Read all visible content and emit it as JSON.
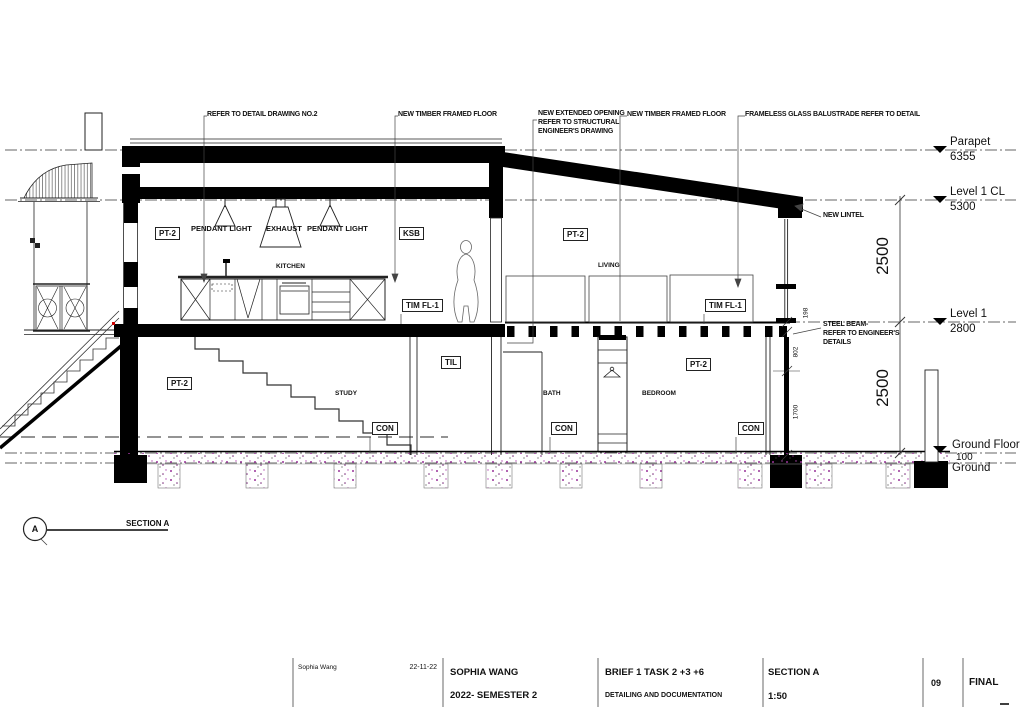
{
  "drawing": {
    "callouts": {
      "c1": "REFER TO DETAIL DRAWING NO.2",
      "c2": "NEW TIMBER FRAMED FLOOR",
      "c3": "NEW EXTENDED OPENING\nREFER TO STRUCTURAL\nENGINEER'S DRAWING",
      "c4": "NEW TIMBER FRAMED FLOOR",
      "c5": "FRAMELESS GLASS BALUSTRADE REFER TO DETAIL",
      "new_lintel": "NEW LINTEL",
      "steel_beam": "STEEL BEAM-\nREFER TO ENGINEER'S\nDETAILS"
    },
    "levels": [
      {
        "name": "Parapet",
        "elevation": "6355"
      },
      {
        "name": "Level 1 CL",
        "elevation": "5300"
      },
      {
        "name": "Level 1",
        "elevation": "2800"
      },
      {
        "name": "Ground Floor",
        "elevation": "100"
      },
      {
        "name": "Ground",
        "elevation": ""
      }
    ],
    "dimensions": {
      "upper_floor_height": "2500",
      "ground_floor_height": "2500",
      "floor_depth": "198",
      "sill": "802",
      "window": "1700"
    },
    "rooms": {
      "kitchen": "KITCHEN",
      "living": "LIVING",
      "study": "STUDY",
      "bath": "BATH",
      "bedroom": "BEDROOM"
    },
    "fixtures": {
      "pendant_left": "PENDANT LIGHT",
      "exhaust": "EXHAUST",
      "pendant_right": "PENDANT LIGHT"
    },
    "material_tags": {
      "pt2_kitchen": "PT-2",
      "ksb": "KSB",
      "pt2_living": "PT-2",
      "tim_fl1_kitchen": "TIM FL-1",
      "tim_fl1_living": "TIM FL-1",
      "til": "TIL",
      "pt2_study": "PT-2",
      "pt2_bedroom": "PT-2",
      "con_study": "CON",
      "con_bath": "CON",
      "con_bedroom": "CON"
    }
  },
  "section_marker": {
    "letter": "A",
    "label": "SECTION A"
  },
  "title_block": {
    "signature": "Sophia Wang",
    "date": "22-11-22",
    "author": "SOPHIA WANG",
    "course": "2022- SEMESTER 2",
    "brief": "BRIEF 1 TASK 2 +3 +6",
    "subtitle": "DETAILING AND DOCUMENTATION",
    "drawing_title": "SECTION A",
    "scale": "1:50",
    "sheet_number": "09",
    "status": "FINAL"
  },
  "colors": {
    "ink": "#000000",
    "speckle": "#993399",
    "accent_red": "#cc0000"
  }
}
